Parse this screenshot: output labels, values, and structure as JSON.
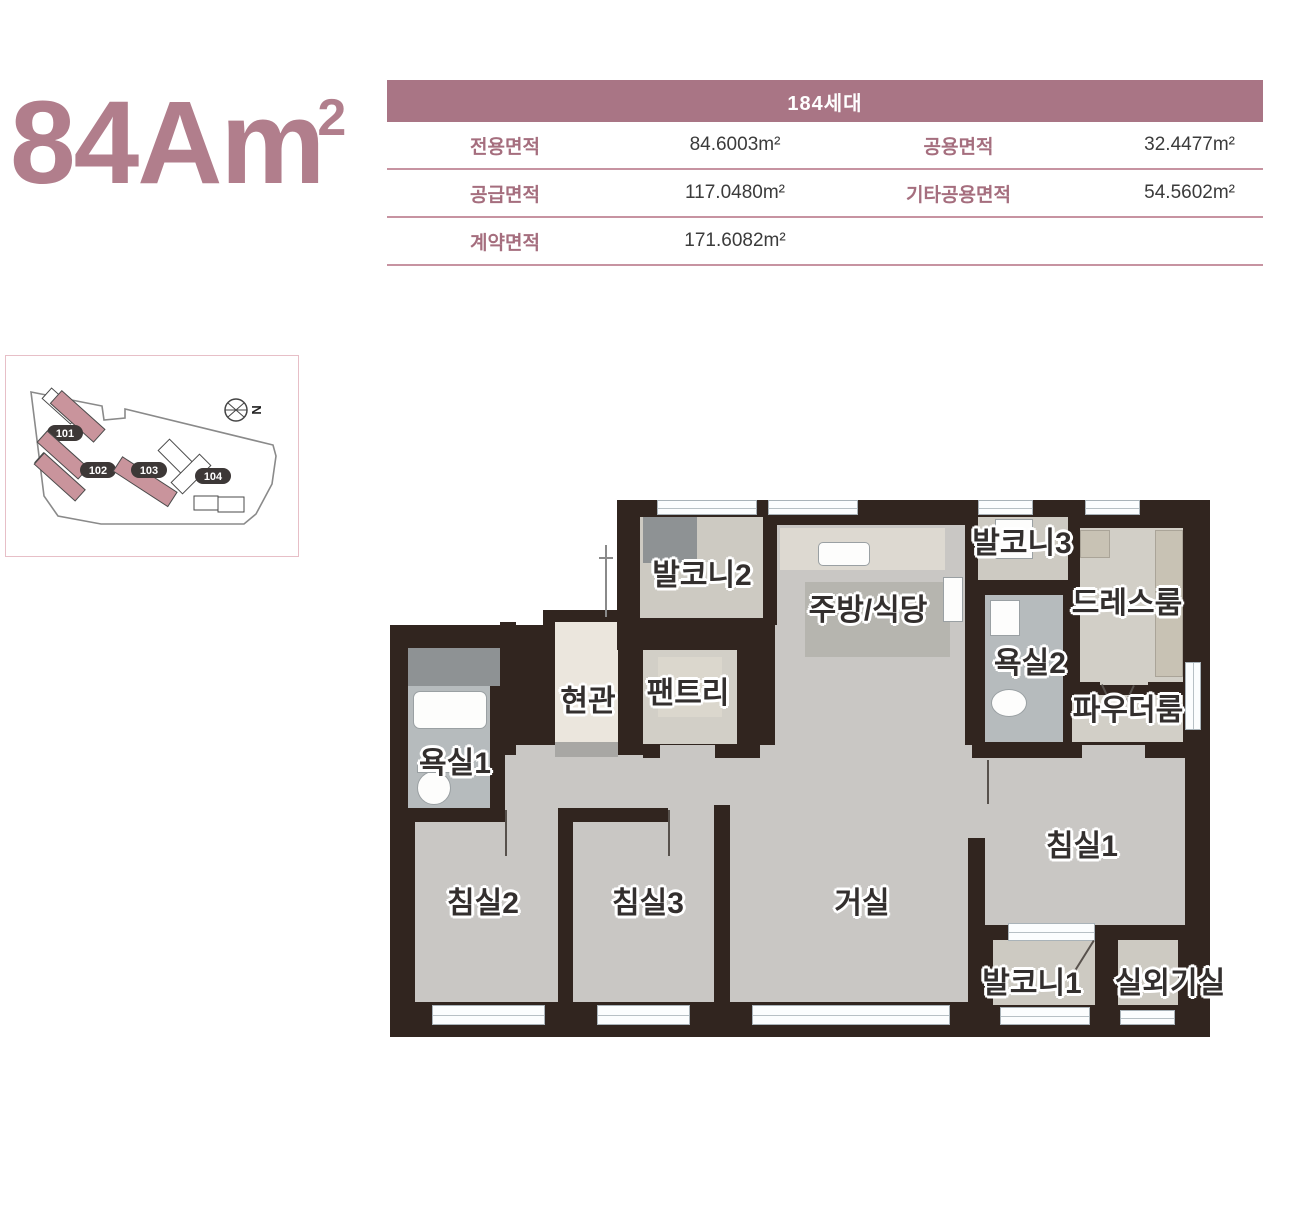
{
  "page": {
    "title": "84Am",
    "title_sup": "2"
  },
  "area_table": {
    "header": "184세대",
    "rows": [
      {
        "label1": "전용면적",
        "value1": "84.6003m²",
        "label2": "공용면적",
        "value2": "32.4477m²"
      },
      {
        "label1": "공급면적",
        "value1": "117.0480m²",
        "label2": "기타공용면적",
        "value2": "54.5602m²"
      },
      {
        "label1": "계약면적",
        "value1": "171.6082m²",
        "label2": "",
        "value2": ""
      }
    ]
  },
  "site_map": {
    "buildings": [
      {
        "label": "101"
      },
      {
        "label": "102"
      },
      {
        "label": "103"
      },
      {
        "label": "104"
      }
    ],
    "compass": "N"
  },
  "floor_plan": {
    "rooms": [
      {
        "label": "발코니2"
      },
      {
        "label": "주방/식당"
      },
      {
        "label": "발코니3"
      },
      {
        "label": "드레스룸"
      },
      {
        "label": "현관"
      },
      {
        "label": "팬트리"
      },
      {
        "label": "욕실2"
      },
      {
        "label": "파우더룸"
      },
      {
        "label": "욕실1"
      },
      {
        "label": "침실2"
      },
      {
        "label": "침실3"
      },
      {
        "label": "거실"
      },
      {
        "label": "침실1"
      },
      {
        "label": "발코니1"
      },
      {
        "label": "실외기실"
      }
    ]
  },
  "colors": {
    "accent_mauve": "#a97585",
    "title_mauve": "#b17e8c",
    "table_divider": "#c793a1",
    "wall": "#31251f",
    "floor": "#c9c7c4",
    "building_pink": "#c9949c"
  }
}
